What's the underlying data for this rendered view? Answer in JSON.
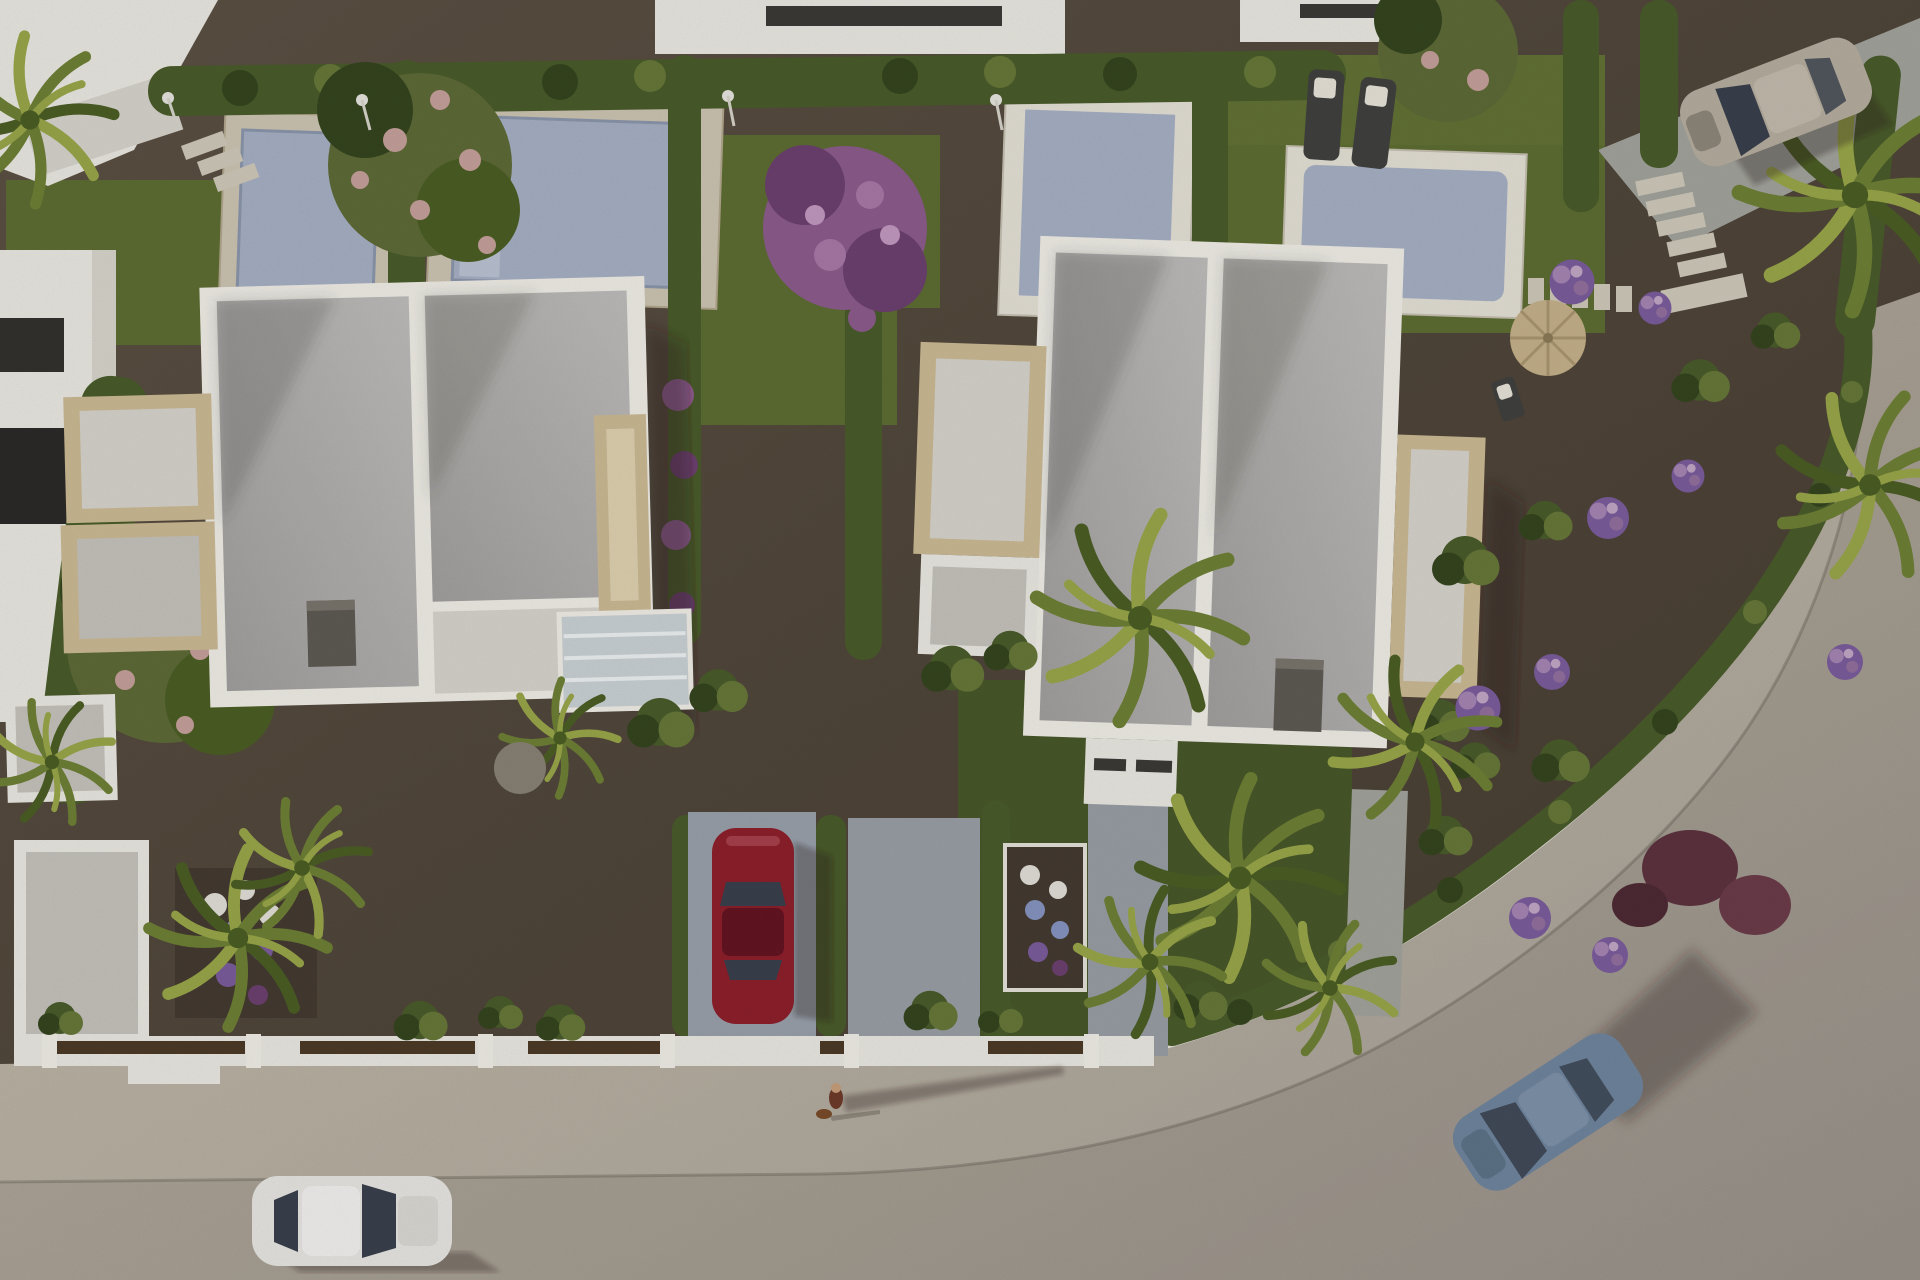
{
  "meta": {
    "type": "aerial-3d-architectural-render",
    "subject": "Top-down render of two modern white duplex villas with private pools, landscaped gravel gardens, hedges, palm trees and a curved street with cars",
    "width": 1920,
    "height": 1280
  },
  "scene": {
    "villas": 2,
    "partial_neighbor_buildings": 4,
    "swimming_pools": 4,
    "vehicles": [
      {
        "name": "red-car",
        "color": "dark red",
        "state": "parked in driveway"
      },
      {
        "name": "white-car",
        "color": "white",
        "state": "driving on street bottom-left"
      },
      {
        "name": "blue-car",
        "color": "steel blue",
        "state": "driving on curved street bottom-right"
      },
      {
        "name": "silver-suv",
        "color": "beige silver",
        "state": "parked on path top-right"
      }
    ],
    "people": [
      {
        "name": "pedestrian",
        "detail": "person with small dog casting long shadow on sidewalk"
      }
    ],
    "garden_elements": [
      "boxwood hedges",
      "bougainvillea",
      "palm trees",
      "pink flowering trees",
      "purple flowering tree",
      "flower beds",
      "stepping stones",
      "outdoor showers",
      "sun loungers",
      "wicker parasol",
      "gravel beds",
      "lawns"
    ]
  },
  "palette": {
    "gravel": "#55493d",
    "gravelDark": "#453b31",
    "gravelLight": "#6a5e50",
    "lawn": "#5e6e33",
    "lawnDark": "#49582a",
    "hedge": "#4a5c2b",
    "hedgeDark": "#36461f",
    "hedgeLight": "#68793a",
    "palm": "#6f8136",
    "palmDark": "#4c5f25",
    "palmLight": "#9aa84a",
    "treeLeaf": "#5f6b38",
    "treePinkBloom": "#c7a29c",
    "treePurple": "#8d5c8d",
    "treePurpleDark": "#6d4170",
    "flowerWhite": "#e3e0da",
    "flowerPurple": "#7c5d9d",
    "flowerBlue": "#8795c2",
    "bushRed": "#5d3340",
    "poolWater": "#a8b2c6",
    "poolWaterLight": "#bcc4d4",
    "poolDeck": "#cec6b4",
    "poolLip": "#e6e2d7",
    "roofTop": "#bfbdbb",
    "roofBottom": "#a19f9d",
    "parapet": "#f1efe8",
    "parapetShade": "#d9d6cd",
    "stone": "#cdbb95",
    "stoneLight": "#e0d3b2",
    "floor": "#c7c4be",
    "floorLight": "#d8d5ce",
    "whiteWall": "#eceae3",
    "chimney": "#5f5b55",
    "glassCanopy": "#ccd3d6",
    "sidewalk": "#c4bcab",
    "road": "#aaa39c",
    "curb": "#ebe8df",
    "pathGray": "#a3a59d",
    "paver": "#d0cabb",
    "fence": "#4e3b28",
    "driveway": "#9aa2ac",
    "carRed": "#8e202c",
    "carRedDark": "#651522",
    "carWhite": "#e9e8e4",
    "carBlue": "#70869f",
    "carSilver": "#b7afa0",
    "glassDark": "#3a414d",
    "lounger": "#41413f",
    "towel": "#e8e4da",
    "parasol": "#c6b28b",
    "skin": "#c99f7c",
    "shirt": "#6f3b2b",
    "dog": "#7b4c2a",
    "shadow": "rgba(40,34,27,0.32)"
  }
}
